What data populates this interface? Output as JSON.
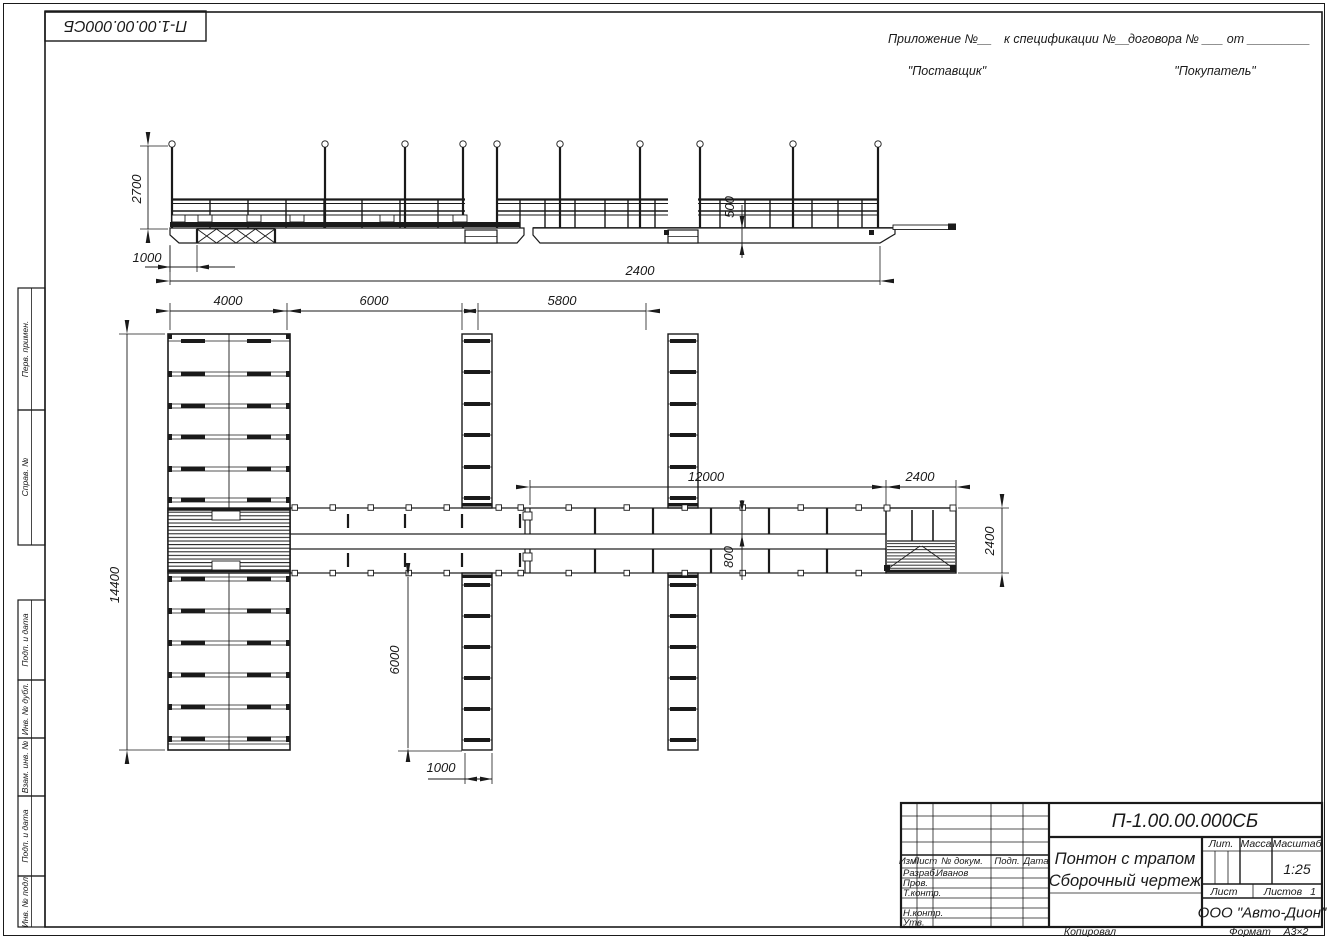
{
  "sheet": {
    "stamp_code": "П-1.00.00.000СБ",
    "copied": "Копировал",
    "format_label": "Формат",
    "format_value": "А3×2"
  },
  "header": {
    "appendix": "Приложение №__",
    "spec": "к спецификации №__",
    "contract": "договора № ___  от _________",
    "supplier": "\"Поставщик\"",
    "buyer": "\"Покупатель\""
  },
  "margin_labels": {
    "perv_primen": "Перв. примен.",
    "sprav_no": "Справ. №",
    "podp_data_1": "Подп. и дата",
    "inv_dubl": "Инв. № дубл.",
    "vzam_inv": "Взам. инв. №",
    "podp_data_2": "Подп. и дата",
    "inv_podl": "Инв. № подл."
  },
  "titleblock": {
    "code": "П-1.00.00.000СБ",
    "name_line1": "Понтон с трапом",
    "name_line2": "Сборочный чертеж",
    "company": "ООО \"Авто-Дион\"",
    "lit_label": "Лит.",
    "mass_label": "Масса",
    "scale_label": "Масштаб",
    "scale_value": "1:25",
    "sheet_label": "Лист",
    "sheets_label": "Листов",
    "sheets_value": "1",
    "col_izm": "Изм.",
    "col_list": "Лист",
    "col_doc": "№ докум.",
    "col_podp": "Подп.",
    "col_data": "Дата",
    "row_razrab": "Разраб.",
    "razrab_value": "Иванов",
    "row_prov": "Пров.",
    "row_tkontr": "Т.контр.",
    "row_nkontr": "Н.контр.",
    "row_utv": "Утв."
  },
  "dimensions": {
    "elev_height": "2700",
    "elev_offset": "1000",
    "elev_freeboard": "500",
    "elev_length": "2400",
    "plan_block_width": "4000",
    "plan_gap1": "6000",
    "plan_gap2": "5800",
    "plan_walkway_len": "12000",
    "plan_ramp_w": "2400",
    "plan_block_len": "14400",
    "plan_walkway_w": "800",
    "plan_pier_len": "6000",
    "plan_pier_w": "1000",
    "plan_ramp_len": "2400"
  }
}
